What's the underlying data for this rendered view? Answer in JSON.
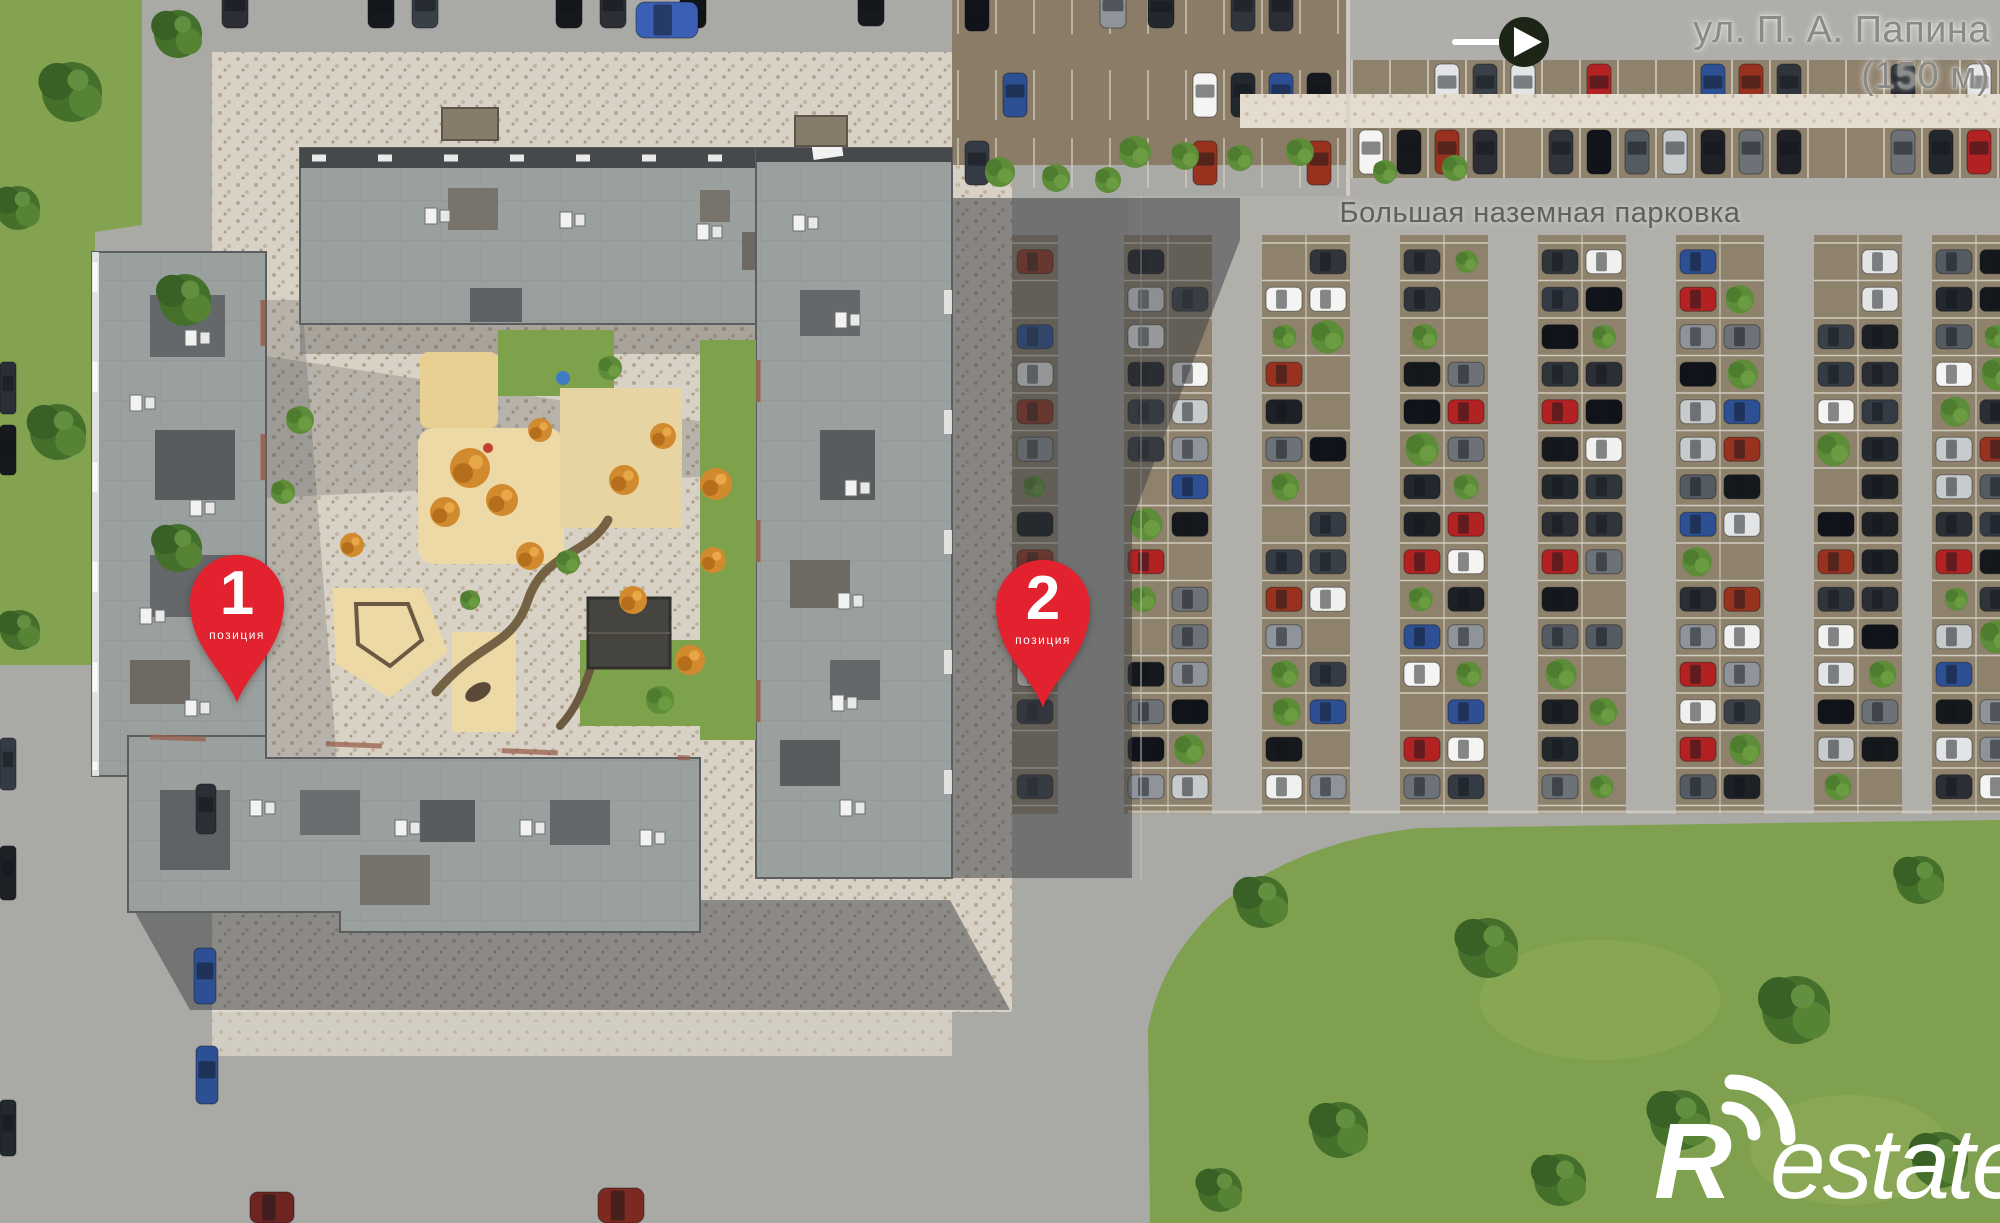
{
  "labels": {
    "street_line1": "ул. П. А. Папина",
    "street_line2": "(150 м)",
    "parking": "Большая наземная парковка"
  },
  "pins": [
    {
      "number": "1",
      "caption": "позиция"
    },
    {
      "number": "2",
      "caption": "позиция"
    }
  ],
  "watermark": {
    "initial": "R",
    "rest": "estate"
  },
  "colors": {
    "pin_red": "#e2222e",
    "street_label_gray": "#8a8a86",
    "parking_label_gray": "#5d605b",
    "arrow_circle_dark": "#1d2517",
    "arrow_white": "#ffffff",
    "watermark_white": "#ffffff",
    "grass_green": "#7fa04e",
    "roof_gray": "#9aa09e",
    "pavement_beige": "#d8d1c5",
    "parking_stall_brown": "#8f826d",
    "sand_beige": "#ecd9a6",
    "orange_tree": "#d28a2e"
  },
  "parking": {
    "stall_fill": "#8f826d",
    "line_color": "#d9d4c8",
    "car_colors": [
      "#2b2f35",
      "#15181c",
      "#f0f0ee",
      "#c8cbcc",
      "#555b63",
      "#353b44",
      "#2d4f94",
      "#b22222",
      "#e2e4e6",
      "#3a4048",
      "#23272e",
      "#8e949a",
      "#1d2126",
      "#6d7278",
      "#98321f",
      "#f4f4f2",
      "#30353c",
      "#10131a"
    ],
    "bush_colors": [
      "#5d8d38",
      "#4f7d2f",
      "#6b9c42"
    ],
    "east": {
      "col_y0": 243,
      "col_y1": 806,
      "stall_h": 37.5,
      "columns": [
        {
          "cx": 1035,
          "type": "single"
        },
        {
          "cx": 1168,
          "type": "double"
        },
        {
          "cx": 1306,
          "type": "double"
        },
        {
          "cx": 1444,
          "type": "double"
        },
        {
          "cx": 1582,
          "type": "double"
        },
        {
          "cx": 1720,
          "type": "double"
        },
        {
          "cx": 1858,
          "type": "double"
        },
        {
          "cx": 1976,
          "type": "double"
        }
      ]
    },
    "north_rows": {
      "x0": 1352,
      "x1": 2000,
      "rows": [
        60,
        126
      ],
      "stall_w": 38,
      "row_h": 52,
      "fill_prob": 0.62
    },
    "nw_lot": {
      "x0": 958,
      "x1": 1344,
      "rows": [
        -16,
        70,
        138
      ],
      "stall_w": 38,
      "row_h": 50,
      "fill_prob": 0.34
    }
  },
  "static_cars": [
    {
      "x": 222,
      "y": -10,
      "w": 26,
      "h": 38,
      "c": "#2b2f35"
    },
    {
      "x": 368,
      "y": -8,
      "w": 26,
      "h": 36,
      "c": "#15181c"
    },
    {
      "x": 412,
      "y": -10,
      "w": 26,
      "h": 38,
      "c": "#3a4048"
    },
    {
      "x": 556,
      "y": -8,
      "w": 26,
      "h": 36,
      "c": "#15181c"
    },
    {
      "x": 600,
      "y": -10,
      "w": 26,
      "h": 38,
      "c": "#2b2f35"
    },
    {
      "x": 680,
      "y": -8,
      "w": 26,
      "h": 36,
      "c": "#101318"
    },
    {
      "x": 636,
      "y": 2,
      "w": 62,
      "h": 36,
      "c": "#3a5fb4"
    },
    {
      "x": 858,
      "y": -8,
      "w": 26,
      "h": 34,
      "c": "#15181c"
    },
    {
      "x": 1100,
      "y": -10,
      "w": 26,
      "h": 38,
      "c": "#8e949a"
    },
    {
      "x": 1148,
      "y": -8,
      "w": 26,
      "h": 36,
      "c": "#23272e"
    },
    {
      "x": 0,
      "y": 362,
      "w": 16,
      "h": 52,
      "c": "#2b2f35"
    },
    {
      "x": 0,
      "y": 425,
      "w": 16,
      "h": 50,
      "c": "#15181c"
    },
    {
      "x": 0,
      "y": 738,
      "w": 16,
      "h": 52,
      "c": "#353b44"
    },
    {
      "x": 0,
      "y": 846,
      "w": 16,
      "h": 54,
      "c": "#1d2126"
    },
    {
      "x": 0,
      "y": 1100,
      "w": 16,
      "h": 56,
      "c": "#23272e"
    },
    {
      "x": 196,
      "y": 784,
      "w": 20,
      "h": 50,
      "c": "#2b2f35"
    },
    {
      "x": 194,
      "y": 948,
      "w": 22,
      "h": 56,
      "c": "#2d4f94"
    },
    {
      "x": 196,
      "y": 1046,
      "w": 22,
      "h": 58,
      "c": "#2d4f94"
    },
    {
      "x": 598,
      "y": 1188,
      "w": 46,
      "h": 35,
      "c": "#7c2a20"
    },
    {
      "x": 250,
      "y": 1192,
      "w": 44,
      "h": 31,
      "c": "#6e2420"
    }
  ],
  "trees": {
    "tree_colors": [
      "#44702c",
      "#3a6125",
      "#578434",
      "#629040"
    ],
    "clusters": [
      {
        "x": 72,
        "y": 92,
        "r": 30
      },
      {
        "x": 178,
        "y": 34,
        "r": 24
      },
      {
        "x": 18,
        "y": 208,
        "r": 22
      },
      {
        "x": 185,
        "y": 300,
        "r": 26
      },
      {
        "x": 58,
        "y": 432,
        "r": 28
      },
      {
        "x": 178,
        "y": 548,
        "r": 24
      },
      {
        "x": 20,
        "y": 630,
        "r": 20
      },
      {
        "x": 1262,
        "y": 902,
        "r": 26
      },
      {
        "x": 1488,
        "y": 948,
        "r": 30
      },
      {
        "x": 1796,
        "y": 1010,
        "r": 34
      },
      {
        "x": 1340,
        "y": 1130,
        "r": 28
      },
      {
        "x": 1680,
        "y": 1120,
        "r": 30
      },
      {
        "x": 1920,
        "y": 880,
        "r": 24
      },
      {
        "x": 1560,
        "y": 1180,
        "r": 26
      },
      {
        "x": 1220,
        "y": 1190,
        "r": 22
      },
      {
        "x": 1940,
        "y": 1160,
        "r": 28
      }
    ],
    "bushes": [
      {
        "x": 1000,
        "y": 172,
        "r": 15
      },
      {
        "x": 1056,
        "y": 178,
        "r": 14
      },
      {
        "x": 1108,
        "y": 180,
        "r": 13
      },
      {
        "x": 1135,
        "y": 152,
        "r": 16
      },
      {
        "x": 1185,
        "y": 156,
        "r": 14
      },
      {
        "x": 1240,
        "y": 158,
        "r": 13
      },
      {
        "x": 1300,
        "y": 152,
        "r": 14
      },
      {
        "x": 1385,
        "y": 172,
        "r": 12
      },
      {
        "x": 1455,
        "y": 168,
        "r": 13
      }
    ]
  }
}
